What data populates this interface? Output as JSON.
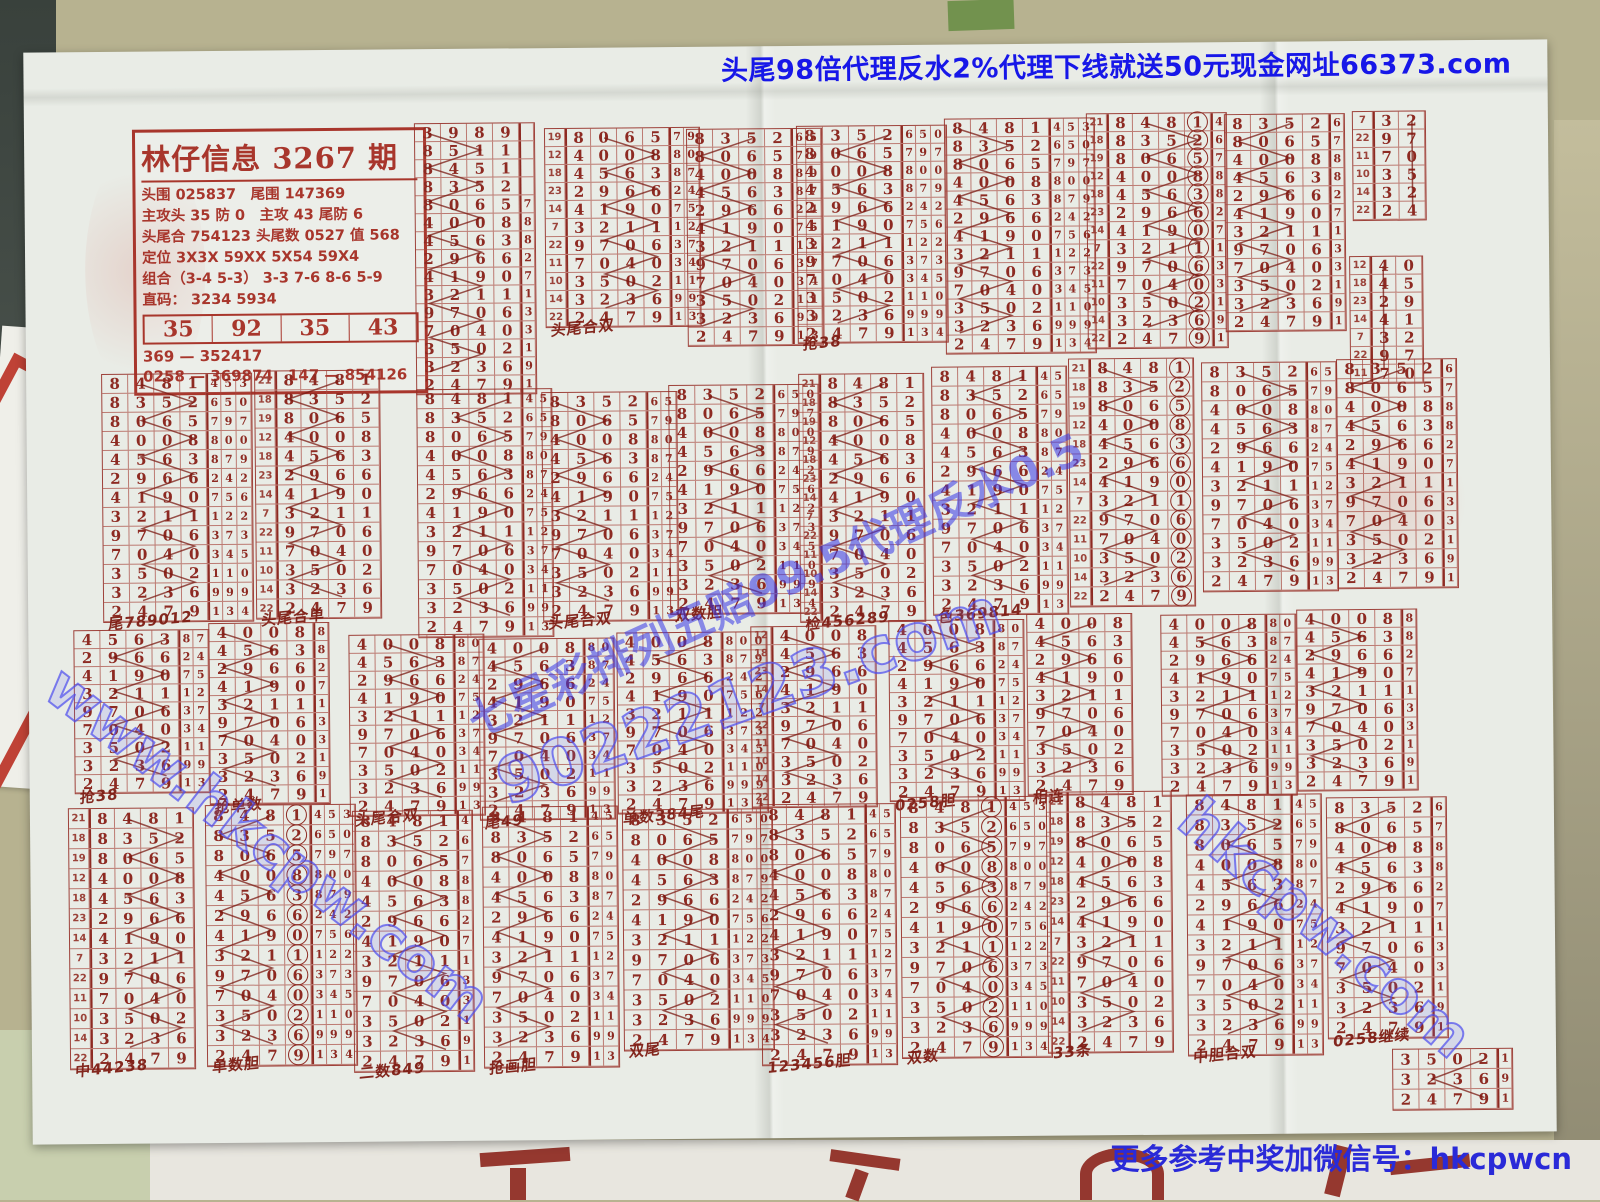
{
  "banner_top": "头尾98倍代理反水2%代理下线就送50元现金网址66373.com",
  "bottom_note": "更多参考中奖加微信号：hkcpwcn",
  "colors": {
    "print_red": "#8d2a22",
    "banner_blue": "#1717e8",
    "watermark_blue": "#4646e8",
    "note_blue": "#2a2ad8"
  },
  "header_box": {
    "title": "林仔信息 3267 期",
    "lines": [
      "头围 025837　尾围 147369",
      "主攻头 35 防 0　主攻 43 尾防 6",
      "头尾合 754123 头尾数 0527 值 568",
      "定位 3X3X 59XX 5X54 59X4",
      "组合（3-4 5-3） 3-3 7-6 8-6 5-9",
      "直码： 3234  5934"
    ],
    "row_values": [
      "35",
      "92",
      "35",
      "43"
    ],
    "footer": [
      "369 — 352417",
      "0258 — 369874　147 — 854126"
    ]
  },
  "watermarks": {
    "diag_main": "七星彩排列五赔99.5代理反水0.5",
    "site1": "90222123.com",
    "site2": "www.hkcpw.com",
    "site3": "hkcpw.com"
  },
  "draws": {
    "prefix": [
      "3989",
      "8511",
      "8451",
      "8352"
    ],
    "row_labels": [
      21,
      18,
      19,
      12,
      18,
      23,
      14,
      7,
      22,
      11,
      10,
      14,
      22
    ],
    "main": [
      "8481",
      "8352",
      "8065",
      "4008",
      "4563",
      "2966",
      "4190",
      "3211",
      "9706",
      "7040",
      "3502",
      "3236",
      "2479"
    ],
    "extra": [
      "453",
      "650",
      "797",
      "800",
      "879",
      "242",
      "756",
      "122",
      "373",
      "345",
      "110",
      "999",
      "134"
    ]
  },
  "blocks": [
    {
      "x": 390,
      "y": 74,
      "rows": 11,
      "start": 2,
      "prefix": true,
      "extra": 1,
      "rh": 17
    },
    {
      "x": 520,
      "y": 80,
      "rows": 11,
      "start": 2,
      "extra": 2,
      "labels": true,
      "rh": 17,
      "ann": "头尾合双"
    },
    {
      "x": 662,
      "y": 82,
      "rows": 12,
      "start": 1,
      "extra": 2,
      "rh": 17
    },
    {
      "x": 772,
      "y": 80,
      "rows": 12,
      "start": 1,
      "extra": 3,
      "rh": 17,
      "ann": "抢38"
    },
    {
      "x": 920,
      "y": 74,
      "rows": 13,
      "start": 0,
      "extra": 3,
      "rh": 17
    },
    {
      "x": 1062,
      "y": 70,
      "rows": 13,
      "start": 0,
      "extra": 1,
      "labels": true,
      "circle": true,
      "rh": 17
    },
    {
      "x": 1200,
      "y": 72,
      "rows": 12,
      "start": 1,
      "extra": 1,
      "rh": 17
    },
    {
      "x": 1328,
      "y": 70,
      "rows": 6,
      "start": 7,
      "cols": 2,
      "labels": true,
      "rh": 17
    },
    {
      "x": 1324,
      "y": 215,
      "rows": 7,
      "start": 3,
      "cols": 2,
      "labels": true,
      "rh": 17
    },
    {
      "x": 75,
      "y": 322,
      "rows": 13,
      "extra": 3,
      "ann": "尾789012"
    },
    {
      "x": 228,
      "y": 320,
      "rows": 13,
      "labels": true,
      "ann": "头尾合单"
    },
    {
      "x": 390,
      "y": 340,
      "rows": 13,
      "extra": 2
    },
    {
      "x": 515,
      "y": 344,
      "rows": 12,
      "start": 1,
      "extra": 2,
      "ann": "头尾合双"
    },
    {
      "x": 642,
      "y": 338,
      "rows": 12,
      "start": 1,
      "extra": 3,
      "ann": "双数胆"
    },
    {
      "x": 772,
      "y": 328,
      "rows": 13,
      "labels": true,
      "ann": "检456289"
    },
    {
      "x": 905,
      "y": 322,
      "rows": 13,
      "extra": 2,
      "ann": "色369814"
    },
    {
      "x": 1042,
      "y": 315,
      "rows": 13,
      "labels": true,
      "circle": true
    },
    {
      "x": 1175,
      "y": 320,
      "rows": 12,
      "start": 1,
      "extra": 2
    },
    {
      "x": 1310,
      "y": 318,
      "rows": 12,
      "start": 1,
      "extra": 1
    },
    {
      "x": 45,
      "y": 578,
      "rows": 9,
      "start": 4,
      "extra": 2,
      "rh": 17,
      "ann": "抢38"
    },
    {
      "x": 180,
      "y": 572,
      "rows": 10,
      "start": 3,
      "extra": 1,
      "rh": 17,
      "ann": "抢单数"
    },
    {
      "x": 320,
      "y": 585,
      "rows": 10,
      "start": 3,
      "extra": 2,
      "rh": 17,
      "ann": "头尾合双"
    },
    {
      "x": 450,
      "y": 590,
      "rows": 10,
      "start": 3,
      "extra": 2,
      "rh": 17,
      "ann": "尾49"
    },
    {
      "x": 588,
      "y": 585,
      "rows": 10,
      "start": 3,
      "extra": 3,
      "rh": 17,
      "ann": "单数384尾"
    },
    {
      "x": 722,
      "y": 580,
      "rows": 10,
      "start": 3,
      "labels": true,
      "rh": 17
    },
    {
      "x": 860,
      "y": 575,
      "rows": 10,
      "start": 3,
      "extra": 2,
      "rh": 17,
      "ann": "0258胆"
    },
    {
      "x": 998,
      "y": 570,
      "rows": 10,
      "start": 3,
      "rh": 17,
      "ann": "相连"
    },
    {
      "x": 1132,
      "y": 572,
      "rows": 10,
      "start": 3,
      "extra": 2,
      "rh": 17
    },
    {
      "x": 1268,
      "y": 568,
      "rows": 10,
      "start": 3,
      "extra": 1,
      "rh": 17
    },
    {
      "x": 38,
      "y": 756,
      "rows": 13,
      "labels": true,
      "rh": 19,
      "ann": "中44238"
    },
    {
      "x": 175,
      "y": 754,
      "rows": 13,
      "extra": 3,
      "circle": true,
      "rh": 19,
      "ann": "单数胆"
    },
    {
      "x": 322,
      "y": 761,
      "rows": 13,
      "extra": 1,
      "rh": 19,
      "ann": "二数849"
    },
    {
      "x": 452,
      "y": 758,
      "rows": 13,
      "extra": 2,
      "rh": 19,
      "ann": "抢画胆"
    },
    {
      "x": 592,
      "y": 762,
      "rows": 12,
      "start": 1,
      "extra": 3,
      "rh": 19,
      "ann": "双尾"
    },
    {
      "x": 730,
      "y": 758,
      "rows": 13,
      "extra": 2,
      "rh": 19,
      "ann": "123456胆"
    },
    {
      "x": 870,
      "y": 752,
      "rows": 13,
      "extra": 3,
      "circle": true,
      "rh": 19,
      "ann": "双数"
    },
    {
      "x": 1016,
      "y": 748,
      "rows": 13,
      "labels": true,
      "rh": 19,
      "ann": "33条"
    },
    {
      "x": 1156,
      "y": 752,
      "rows": 13,
      "extra": 2,
      "rh": 19,
      "ann": "中胆合双"
    },
    {
      "x": 1296,
      "y": 756,
      "rows": 12,
      "start": 1,
      "extra": 1,
      "rh": 19,
      "ann": "0258继续"
    },
    {
      "x": 1360,
      "y": 1008,
      "rows": 3,
      "start": 10,
      "extra": 1,
      "rh": 19
    }
  ]
}
